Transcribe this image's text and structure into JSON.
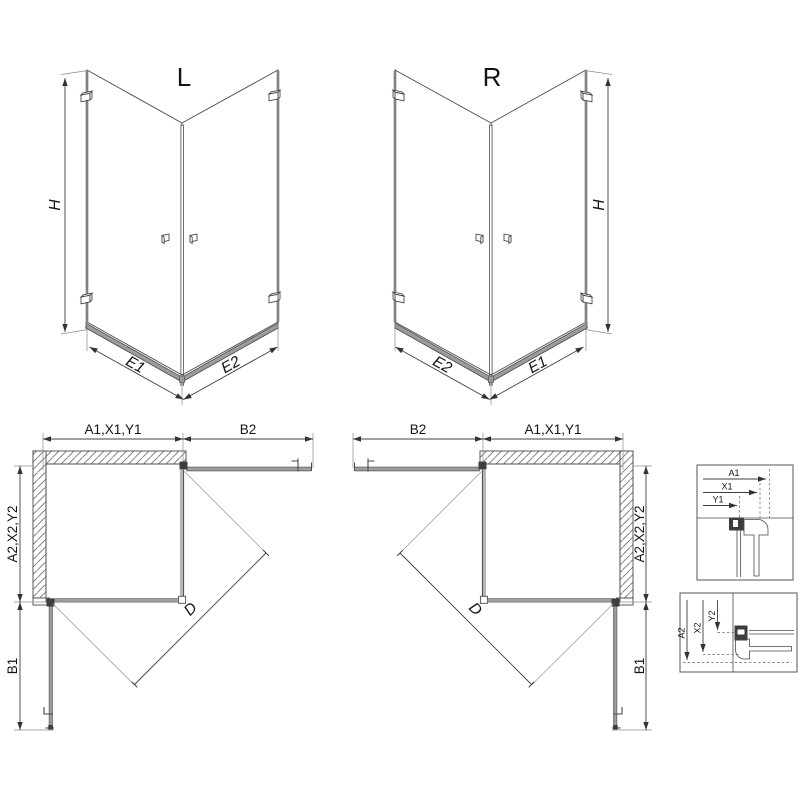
{
  "drawing": {
    "perspective_left": {
      "label": "L",
      "height": "H",
      "edge_left": "E1",
      "edge_right": "E2"
    },
    "perspective_right": {
      "label": "R",
      "height": "H",
      "edge_left": "E2",
      "edge_right": "E1"
    },
    "plan_left": {
      "width_inner": "A1,X1,Y1",
      "width_door": "B2",
      "depth_inner": "A2,X2,Y2",
      "depth_door": "B1",
      "diagonal": "D"
    },
    "plan_right": {
      "width_door": "B2",
      "width_inner": "A1,X1,Y1",
      "depth_inner": "A2,X2,Y2",
      "depth_door": "B1",
      "diagonal": "D"
    },
    "detail_horizontal": {
      "dims": [
        "A1",
        "X1",
        "Y1"
      ]
    },
    "detail_vertical": {
      "dims": [
        "A2",
        "X2",
        "Y2"
      ]
    },
    "colors": {
      "line": "#3f3f3f",
      "panel_gray": "#9e9e9e",
      "hatch": "#6e6e6e",
      "background": "#ffffff"
    }
  }
}
